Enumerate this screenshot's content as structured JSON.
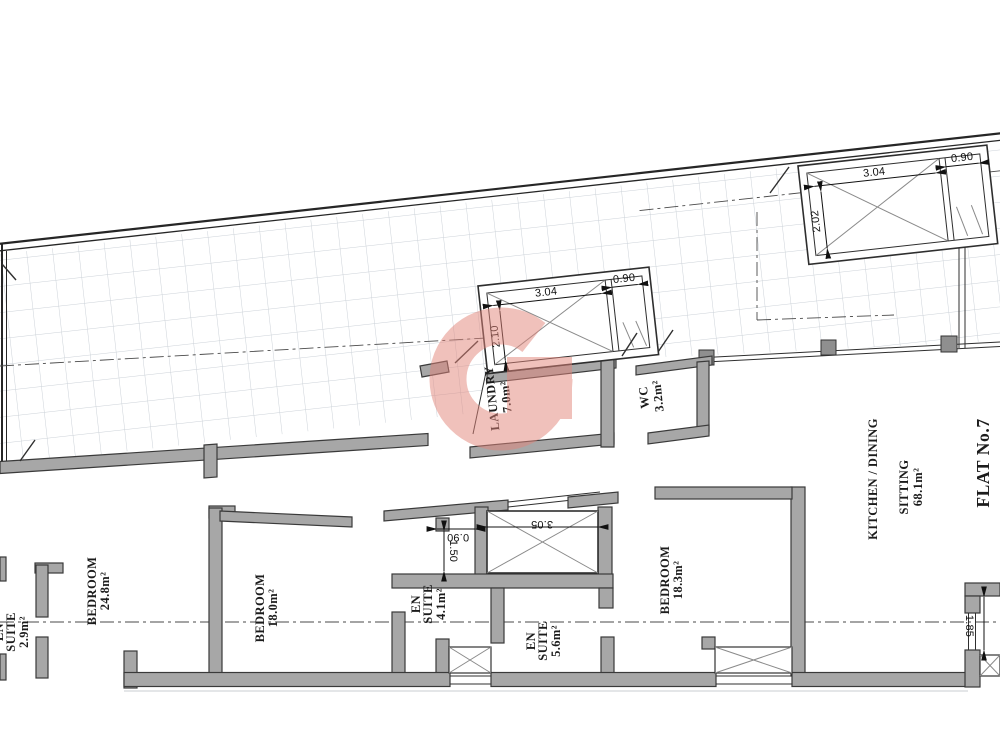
{
  "plan": {
    "flat_label": "FLAT No.7",
    "rooms": {
      "laundry": {
        "name": "LAUNDRY",
        "area": "7.0m²"
      },
      "wc": {
        "name": "WC",
        "area": "3.2m²"
      },
      "kitchen": {
        "line1": "KITCHEN / DINING",
        "line2": "SITTING",
        "area": "68.1m²"
      },
      "bedroom1": {
        "name": "BEDROOM",
        "area": "24.8m²"
      },
      "bedroom2": {
        "name": "BEDROOM",
        "area": "18.0m²"
      },
      "bedroom3": {
        "name": "BEDROOM",
        "area": "18.3m²"
      },
      "ensuite1": {
        "line1": "EN",
        "line2": "SUITE",
        "area": "2.9m²"
      },
      "ensuite2": {
        "line1": "EN",
        "line2": "SUITE",
        "area": "4.1m²"
      },
      "ensuite3": {
        "line1": "EN",
        "line2": "SUITE",
        "area": "5.6m²"
      }
    },
    "dimensions": {
      "shaft_top_right": {
        "width": "3.04",
        "sub": "0.90",
        "depth": "2.02"
      },
      "shaft_central": {
        "width": "3.04",
        "sub": "0.90",
        "depth": "2.10"
      },
      "shaft_lower": {
        "width": "3.05",
        "door": "0.90",
        "depth": "1.50"
      },
      "window_right": "1.85"
    }
  },
  "watermark": {
    "letter": "G",
    "color": "#e2857a"
  }
}
